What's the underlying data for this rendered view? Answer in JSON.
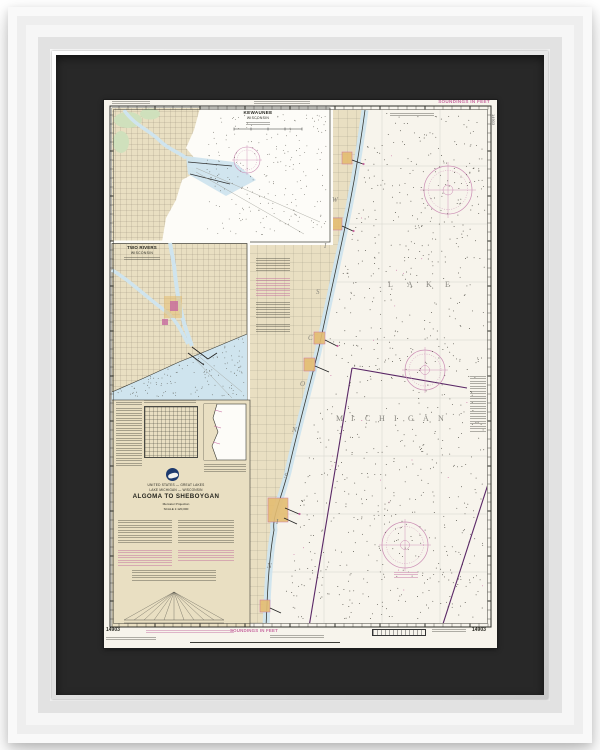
{
  "artwork": {
    "kind": "framed-nautical-chart",
    "frame_color": "white",
    "matte_color": "black"
  },
  "chart": {
    "title": "ALGOMA TO SHEBOYGAN",
    "country_line": "UNITED STATES — GREAT LAKES",
    "region_line": "LAKE MICHIGAN — WISCONSIN",
    "projection_line": "Mercator Projection",
    "scale_line": "SCALE 1:120,000",
    "soundings_top": "SOUNDINGS IN FEET",
    "soundings_bottom": "SOUNDINGS IN FEET",
    "chart_number_left": "14903",
    "chart_number_right": "14903",
    "chart_number_edge": "14903",
    "lake_word_1": "LAKE",
    "lake_word_2": "MICHIGAN",
    "state_word": "WISCONSIN",
    "insets": [
      {
        "id": "kewaunee",
        "title": "KEWAUNEE",
        "subtitle": "WISCONSIN"
      },
      {
        "id": "two-rivers",
        "title": "TWO RIVERS",
        "subtitle": "WISCONSIN"
      }
    ],
    "colors": {
      "paper": "#f7f4ec",
      "land": "#e9dfc2",
      "water_shallow": "#cfe4ee",
      "marsh_green": "#cfe0bc",
      "magenta": "#c76aa0",
      "boundary_purple": "#5a2766",
      "city_yellow": "#e4bd72",
      "matte": "#282828",
      "frame": "#f3f3f3",
      "ink": "#35352e"
    }
  }
}
